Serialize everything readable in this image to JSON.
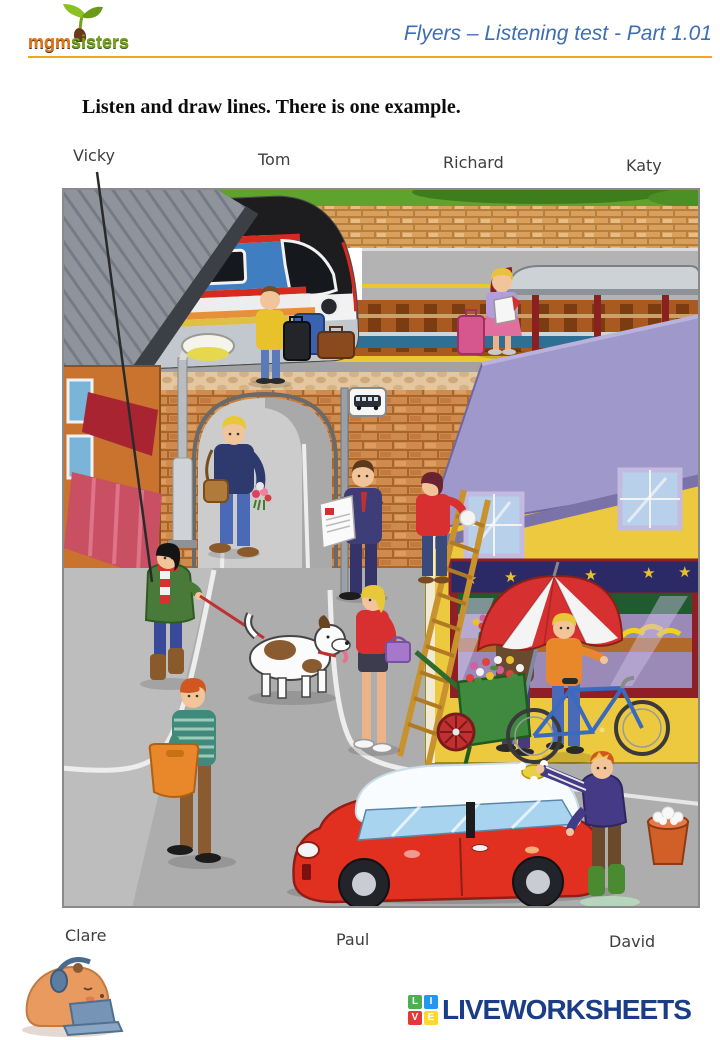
{
  "header": {
    "logo": {
      "mgm": "mgm",
      "sisters": "sisters"
    },
    "title": "Flyers – Listening test - Part 1.01",
    "title_color": "#3c6eb4",
    "rule_color": "#f2a71b"
  },
  "instruction": "Listen and draw lines. There is one example.",
  "worksheet": {
    "names_top": [
      "Vicky",
      "Tom",
      "Richard",
      "Katy"
    ],
    "names_bottom": [
      "Clare",
      "Paul",
      "David"
    ],
    "illustration_alt": "Busy street scene at a railway station: a train and platforms with waiting passengers at the top, a brick bridge with an arch, a street lamp and bus stop sign, shops, a man reading a newspaper, a woman cleaning a window on a ladder, a woman walking a dog on a red leash, a boy carrying an orange bag, a girl with a purple handbag, a flower seller under a red and white umbrella with a green flower cart, a boy with a bicycle and a man washing a red car with a bucket of soapy water.",
    "example_line": {
      "from": "Vicky",
      "to": "woman walking the dog"
    }
  },
  "footer": {
    "brand": "LIVEWORKSHEETS",
    "brand_color": "#1b3c87",
    "tiles": [
      {
        "letter": "L",
        "color": "#4caf50"
      },
      {
        "letter": "I",
        "color": "#2196f3"
      },
      {
        "letter": "V",
        "color": "#e53935"
      },
      {
        "letter": "E",
        "color": "#fdd835"
      }
    ]
  }
}
